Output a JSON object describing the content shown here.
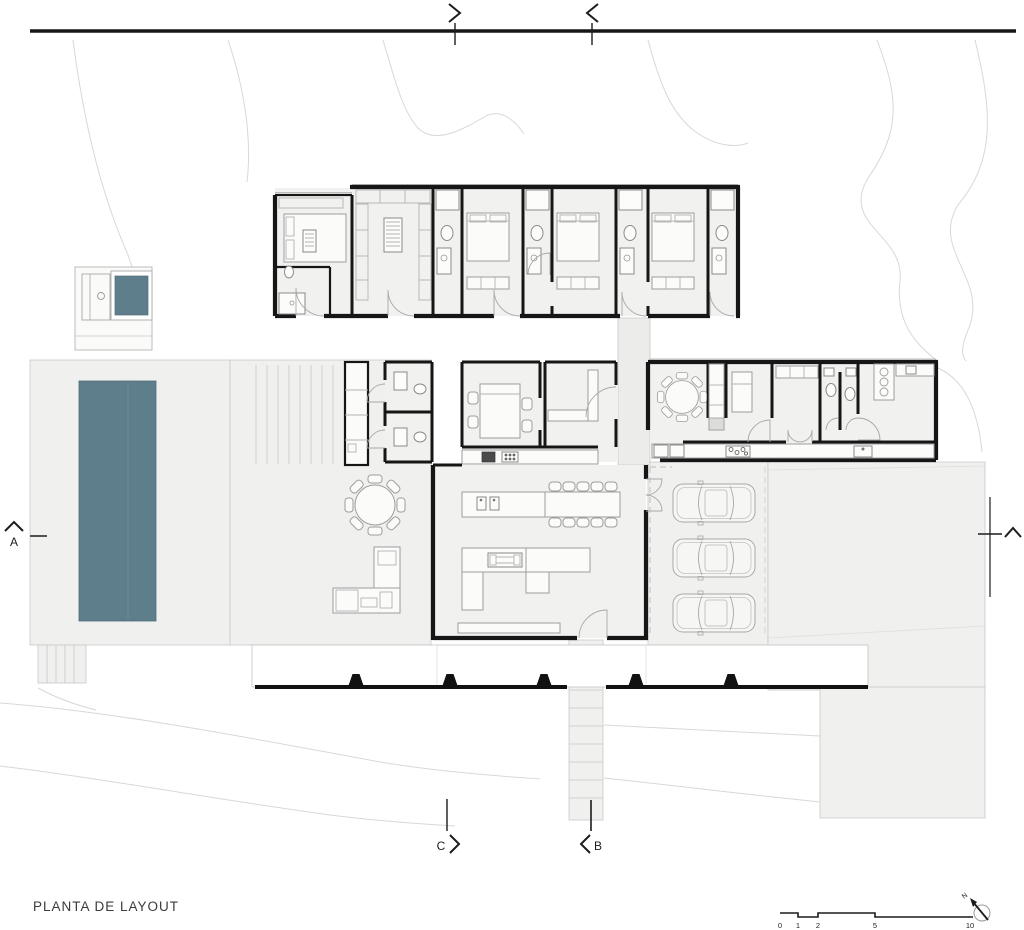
{
  "title_block": {
    "drawing_title": "PLANTA DE LAYOUT"
  },
  "section_markers": {
    "left_label": "A",
    "bottom_left_label": "C",
    "bottom_right_label": "B"
  },
  "scale_bar": {
    "tick_labels": [
      "0",
      "1",
      "2",
      "5",
      "10"
    ]
  },
  "north_arrow": {
    "label": "N"
  },
  "colors": {
    "pool_water": "#5f7e8b",
    "spa_water": "#5f7e8b",
    "wall_ink": "#161616",
    "paving": "#f0f0ef",
    "veranda": "#ffffff"
  }
}
